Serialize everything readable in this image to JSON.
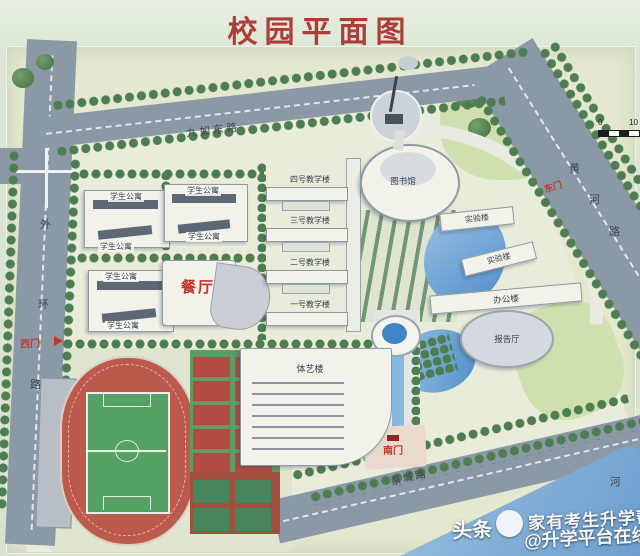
{
  "title": "校园平面图",
  "colors": {
    "title_red": "#ae3d3a",
    "gate_red": "#c0392b",
    "road_gray": "#8b98a6",
    "water_blue": "#6d9fce",
    "track_red": "#bc5a4b",
    "field_green": "#55a063",
    "tree_green": "#4e7d52",
    "wall_green": "#d9e5d2"
  },
  "roads": {
    "north": {
      "label": "九如东路"
    },
    "west": {
      "label": "外环路"
    },
    "east": {
      "label": "黄河路"
    },
    "south": {
      "label": "蔡城路"
    },
    "river": {
      "label": "河"
    }
  },
  "gates": {
    "west": {
      "label": "西门"
    },
    "east": {
      "label": "东门"
    },
    "south": {
      "label": "南门"
    }
  },
  "buildings": {
    "apartments": [
      {
        "label": "学生公寓"
      },
      {
        "label": "学生公寓"
      },
      {
        "label": "学生公寓"
      },
      {
        "label": "学生公寓"
      },
      {
        "label": "学生公寓"
      },
      {
        "label": "学生公寓"
      }
    ],
    "dining": {
      "label": "餐厅"
    },
    "teaching": [
      {
        "label": "四号教学楼"
      },
      {
        "label": "三号教学楼"
      },
      {
        "label": "二号教学楼"
      },
      {
        "label": "一号教学楼"
      }
    ],
    "library": {
      "label": "图书馆"
    },
    "labs": [
      {
        "label": "实验楼"
      },
      {
        "label": "实验楼"
      }
    ],
    "office": {
      "label": "办公楼"
    },
    "lecture_hall": {
      "label": "报告厅"
    },
    "pe_arts": {
      "label": "体艺楼"
    }
  },
  "scalebar": {
    "start": "0",
    "end": "10"
  },
  "watermark": {
    "brand": "头条",
    "line1": "家有考生升学帮",
    "line2": "@升学平台在线"
  }
}
